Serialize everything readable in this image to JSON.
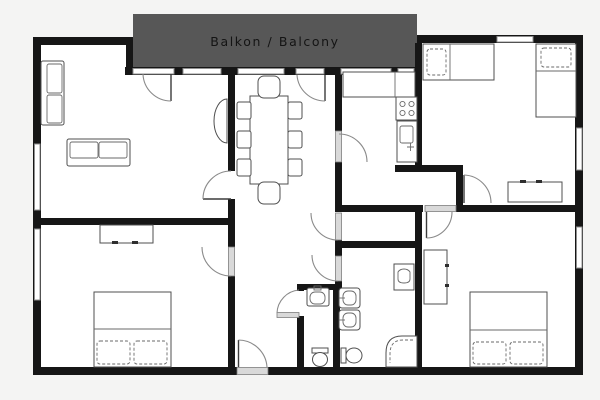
{
  "balcony": {
    "label": "Balkon / Balcony",
    "fill": "#575757",
    "text_color": "#141414"
  },
  "colors": {
    "background": "#f4f4f3",
    "floor": "#ffffff",
    "wall": "#161616",
    "window_frame": "#8f8f8f",
    "door_arc": "#8a8a8a",
    "door_leaf": "#3c3c3c",
    "furniture_stroke": "#4f4f4f"
  },
  "icons": {
    "furniture_glyphs": [
      "sofa-icon",
      "dining-table-icon",
      "chair-icon",
      "radiator-icon",
      "kitchen-counter-icon",
      "stove-icon",
      "kitchen-sink-icon",
      "single-bed-icon",
      "double-bed-icon",
      "pillow-icon",
      "dresser-icon",
      "wardrobe-icon",
      "washing-machine-icon",
      "bathroom-sink-icon",
      "toilet-icon",
      "corner-shower-icon",
      "door-swing-icon",
      "window-icon"
    ]
  }
}
